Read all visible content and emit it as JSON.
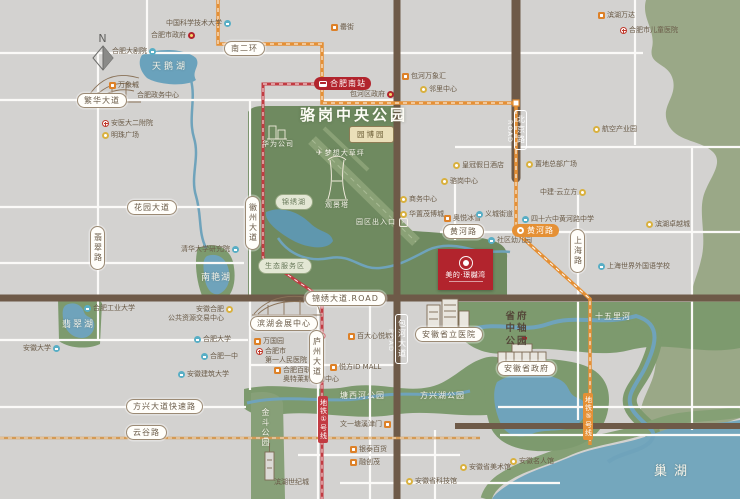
{
  "compass": {
    "label": "N"
  },
  "park": {
    "title": "骆岗中央公园"
  },
  "project": {
    "name": "美的·璟樾湾"
  },
  "colors": {
    "background": "#d3d2d0",
    "park_green": "#6f8a60",
    "band_green": "#7d9a6e",
    "pale_green": "#9aa887",
    "water_blue": "#6fa3bb",
    "road_brown": "#6e5a48",
    "metro_orange": "#e59035",
    "metro_red": "#c23b42",
    "project_red": "#b2242d",
    "label_brown": "#6b5c49"
  },
  "metro_badges": [
    {
      "label": "合肥南站",
      "x": 314,
      "y": 77,
      "color": "red",
      "icon": "train-icon"
    },
    {
      "label": "黄河路",
      "x": 512,
      "y": 224,
      "color": "orange",
      "icon": "metro-icon"
    }
  ],
  "metro_line_labels": [
    {
      "label": "地铁①号线",
      "x": 318,
      "y": 396,
      "color": "red"
    },
    {
      "label": "地铁⑤号线",
      "x": 583,
      "y": 393,
      "color": "orange"
    }
  ],
  "road_badges": [
    {
      "label": "南二环",
      "x": 224,
      "y": 41
    },
    {
      "label": "繁华大道",
      "x": 77,
      "y": 93
    },
    {
      "label": "花园大道",
      "x": 127,
      "y": 200
    },
    {
      "label": "方兴大道快速路",
      "x": 126,
      "y": 399
    },
    {
      "label": "云谷路",
      "x": 126,
      "y": 425
    },
    {
      "label": "黄河路",
      "x": 443,
      "y": 224
    },
    {
      "label": "锦绣大道.ROAD",
      "x": 305,
      "y": 291
    },
    {
      "label": "滨湖会展中心",
      "x": 250,
      "y": 316
    },
    {
      "label": "安徽省立医院",
      "x": 415,
      "y": 327
    },
    {
      "label": "安徽省政府",
      "x": 497,
      "y": 361
    },
    {
      "label": "翡翠路",
      "x": 90,
      "y": 226,
      "vert": true
    },
    {
      "label": "徽州大道",
      "x": 245,
      "y": 196,
      "vert": true
    },
    {
      "label": "庐州大道",
      "x": 309,
      "y": 330,
      "vert": true
    },
    {
      "label": "上海路",
      "x": 570,
      "y": 229,
      "vert": true
    }
  ],
  "road_on_labels": [
    {
      "label": "北京路",
      "sub": "ROAD",
      "x": 506,
      "y": 110
    },
    {
      "label": "包河大道",
      "sub": "ROAD",
      "x": 387,
      "y": 314
    }
  ],
  "area_labels": [
    {
      "label": "天鹅湖",
      "x": 152,
      "y": 59,
      "size": 9,
      "ls": 3
    },
    {
      "label": "翡翠湖",
      "x": 62,
      "y": 317,
      "size": 9,
      "ls": 2
    },
    {
      "label": "南艳湖",
      "x": 201,
      "y": 270,
      "size": 9,
      "ls": 1
    },
    {
      "label": "巢湖",
      "x": 654,
      "y": 460,
      "size": 13,
      "ls": 7
    },
    {
      "label": "十五里河",
      "x": 595,
      "y": 311,
      "size": 8,
      "ls": 1
    },
    {
      "label": "塘西河公园",
      "x": 340,
      "y": 390,
      "size": 8,
      "ls": 1
    },
    {
      "label": "方兴湖公园",
      "x": 420,
      "y": 390,
      "size": 8,
      "ls": 1
    },
    {
      "label": "金斗公园",
      "x": 260,
      "y": 408,
      "size": 8,
      "ls": 2,
      "vert": true
    },
    {
      "label": "梦想大草坪",
      "x": 316,
      "y": 148,
      "size": 7,
      "icon": "plane"
    },
    {
      "label": "观景塔",
      "x": 325,
      "y": 200,
      "size": 7
    },
    {
      "label": "华为公司",
      "x": 262,
      "y": 139,
      "size": 7
    },
    {
      "label": "园区出入口",
      "x": 356,
      "y": 217,
      "size": 7,
      "arrow": true
    },
    {
      "label": "锦绣湖",
      "x": 275,
      "y": 194,
      "pill": "green"
    },
    {
      "label": "生态服务区",
      "x": 258,
      "y": 258,
      "pill": "green"
    },
    {
      "label": "园博园",
      "x": 349,
      "y": 126,
      "pill": "tan"
    },
    {
      "label": "省府中轴公园",
      "x": 504,
      "y": 311,
      "stack": true
    }
  ],
  "pois": [
    {
      "icon": "blue",
      "side": "r",
      "label": "中国科学技术大学",
      "x": 166,
      "y": 19
    },
    {
      "icon": "gov",
      "side": "r",
      "label": "合肥市政府",
      "x": 151,
      "y": 31
    },
    {
      "icon": "blue",
      "side": "r",
      "label": "合肥大剧院",
      "x": 112,
      "y": 47
    },
    {
      "icon": "orange",
      "label": "万象城",
      "x": 109,
      "y": 81
    },
    {
      "icon": "none",
      "label": "合肥政务中心",
      "x": 137,
      "y": 91
    },
    {
      "icon": "redcross",
      "label": "安医大二附院",
      "x": 102,
      "y": 119
    },
    {
      "icon": "yellow",
      "label": "明珠广场",
      "x": 102,
      "y": 131
    },
    {
      "icon": "orange",
      "label": "罍街",
      "x": 331,
      "y": 23
    },
    {
      "icon": "gov",
      "side": "r",
      "label": "包河区政府",
      "x": 350,
      "y": 90
    },
    {
      "icon": "orange",
      "label": "包河万象汇",
      "x": 402,
      "y": 72
    },
    {
      "icon": "yellow",
      "label": "邻里中心",
      "x": 420,
      "y": 85
    },
    {
      "icon": "orange",
      "label": "滨湖万达",
      "x": 598,
      "y": 11
    },
    {
      "icon": "redcross",
      "label": "合肥市儿童医院",
      "x": 620,
      "y": 26
    },
    {
      "icon": "yellow",
      "label": "航空产业园",
      "x": 593,
      "y": 125
    },
    {
      "icon": "yellow",
      "label": "置地总部广场",
      "x": 526,
      "y": 160
    },
    {
      "icon": "yellow",
      "side": "r",
      "label": "中建·云立方",
      "x": 540,
      "y": 188
    },
    {
      "icon": "blue",
      "label": "四十六中黄河路中学",
      "x": 522,
      "y": 215
    },
    {
      "icon": "yellow",
      "label": "滨湖卓越城",
      "x": 646,
      "y": 220
    },
    {
      "icon": "blue",
      "label": "上海世界外国语学校",
      "x": 598,
      "y": 262
    },
    {
      "icon": "yellow",
      "label": "骆岗中心",
      "x": 441,
      "y": 177
    },
    {
      "icon": "yellow",
      "label": "商务中心",
      "x": 400,
      "y": 195
    },
    {
      "icon": "yellow",
      "label": "华置茂博城",
      "x": 400,
      "y": 210
    },
    {
      "icon": "orange",
      "label": "奥悦冰雪",
      "x": 444,
      "y": 214
    },
    {
      "icon": "blue",
      "label": "义城街道",
      "x": 476,
      "y": 210
    },
    {
      "icon": "blue",
      "label": "社区幼儿园",
      "x": 488,
      "y": 236
    },
    {
      "icon": "yellow",
      "label": "皇冠假日酒店",
      "x": 453,
      "y": 161
    },
    {
      "icon": "blue",
      "side": "r",
      "label": "清华大学研究院",
      "x": 181,
      "y": 245
    },
    {
      "icon": "blue",
      "label": "合肥工业大学",
      "x": 84,
      "y": 304
    },
    {
      "icon": "yellow",
      "side": "r",
      "label": "安徽合肥\n公共资源交易中心",
      "x": 168,
      "y": 305
    },
    {
      "icon": "blue",
      "side": "r",
      "label": "安徽大学",
      "x": 23,
      "y": 344
    },
    {
      "icon": "blue",
      "label": "合肥大学",
      "x": 194,
      "y": 335
    },
    {
      "icon": "blue",
      "label": "合肥一中",
      "x": 201,
      "y": 352
    },
    {
      "icon": "blue",
      "label": "安徽建筑大学",
      "x": 178,
      "y": 370
    },
    {
      "icon": "orange",
      "label": "万国园",
      "x": 254,
      "y": 337
    },
    {
      "icon": "redcross",
      "label": "合肥市\n第一人民医院",
      "x": 256,
      "y": 347
    },
    {
      "icon": "orange",
      "label": "合肥百联\n奥特莱斯购物中心",
      "x": 274,
      "y": 366
    },
    {
      "icon": "orange",
      "label": "百大心悦城",
      "x": 348,
      "y": 332
    },
    {
      "icon": "orange",
      "label": "悦方ID MALL",
      "x": 330,
      "y": 363
    },
    {
      "icon": "orange",
      "side": "r",
      "label": "文一塘溪津门",
      "x": 340,
      "y": 420
    },
    {
      "icon": "orange",
      "label": "银泰百货",
      "x": 350,
      "y": 445
    },
    {
      "icon": "orange",
      "label": "融创茂",
      "x": 350,
      "y": 458
    },
    {
      "icon": "none",
      "label": "滨湖世纪城",
      "x": 274,
      "y": 478
    },
    {
      "icon": "yellow",
      "label": "安徽省美术馆",
      "x": 460,
      "y": 463
    },
    {
      "icon": "yellow",
      "label": "安徽省科技馆",
      "x": 406,
      "y": 477
    },
    {
      "icon": "yellow",
      "label": "安徽名人馆",
      "x": 510,
      "y": 457
    }
  ]
}
